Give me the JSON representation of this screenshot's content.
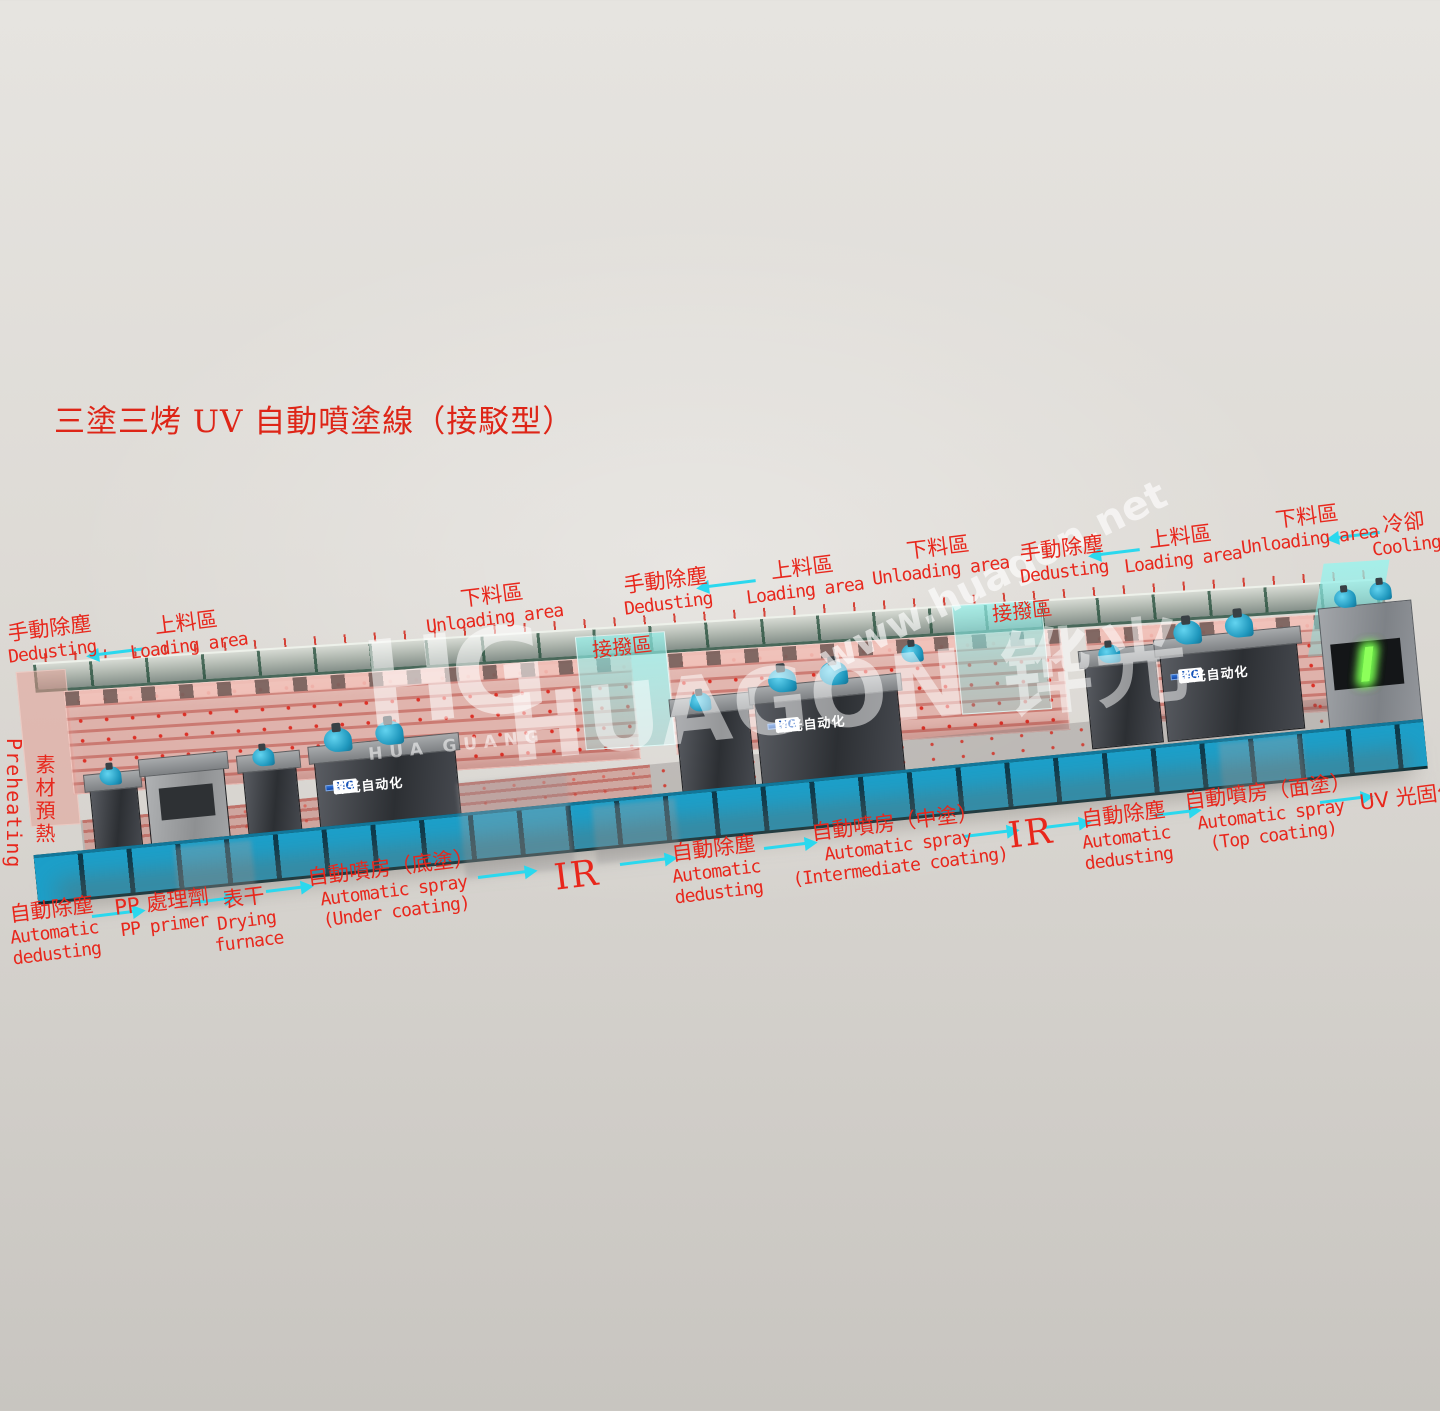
{
  "title": "三塗三烤 UV 自動噴塗線（接駁型）",
  "watermark": {
    "logo": "HG",
    "logo_caption": "HUA GUANG",
    "brand": "HUAGON 铧光",
    "url": "www.huagon.net"
  },
  "machine": {
    "booth_sign_logo": "HG",
    "booth_sign": "铧光自动化",
    "preheat": {
      "zh": "素材預熱",
      "en": "Preheating"
    },
    "colors": {
      "label_red": "#e8271c",
      "arrow_cyan": "#2ad8ee",
      "conveyor_blue": "#1b9fc9",
      "oven_pink": "#e2948a",
      "dock_cyan": "#94f2ec",
      "uv_green": "#8dff5a",
      "sign_blue": "#1e5cc0"
    }
  },
  "dock_labels": [
    "接撥區",
    "接撥區"
  ],
  "top_labels": [
    {
      "zh": "手動除塵",
      "en": "Dedusting"
    },
    {
      "zh": "上料區",
      "en": "Loading area"
    },
    {
      "zh": "下料區",
      "en": "Unloading area"
    },
    {
      "zh": "手動除塵",
      "en": "Dedusting"
    },
    {
      "zh": "上料區",
      "en": "Loading area"
    },
    {
      "zh": "下料區",
      "en": "Unloading area"
    },
    {
      "zh": "手動除塵",
      "en": "Dedusting"
    },
    {
      "zh": "上料區",
      "en": "Loading area"
    },
    {
      "zh": "下料區",
      "en": "Unloading area"
    },
    {
      "zh": "冷卻",
      "en": "Cooling"
    }
  ],
  "bottom_labels": [
    {
      "zh": "自動除塵",
      "en1": "Automatic",
      "en2": "dedusting"
    },
    {
      "zh": "PP 處理劑",
      "en1": "PP primer",
      "en2": ""
    },
    {
      "zh": "表干",
      "en1": "Drying",
      "en2": "furnace"
    },
    {
      "zh": "自動噴房（底塗）",
      "en1": "Automatic spray",
      "en2": "(Under coating)"
    },
    {
      "zh": "",
      "en1": "IR",
      "en2": ""
    },
    {
      "zh": "自動除塵",
      "en1": "Automatic",
      "en2": "dedusting"
    },
    {
      "zh": "自動噴房（中塗）",
      "en1": "Automatic spray",
      "en2": "(Intermediate coating)"
    },
    {
      "zh": "",
      "en1": "IR",
      "en2": ""
    },
    {
      "zh": "自動除塵",
      "en1": "Automatic",
      "en2": "dedusting"
    },
    {
      "zh": "自動噴房（面塗）",
      "en1": "Automatic spray",
      "en2": "(Top coating)"
    },
    {
      "zh": "UV 光固化",
      "en1": "",
      "en2": ""
    }
  ]
}
